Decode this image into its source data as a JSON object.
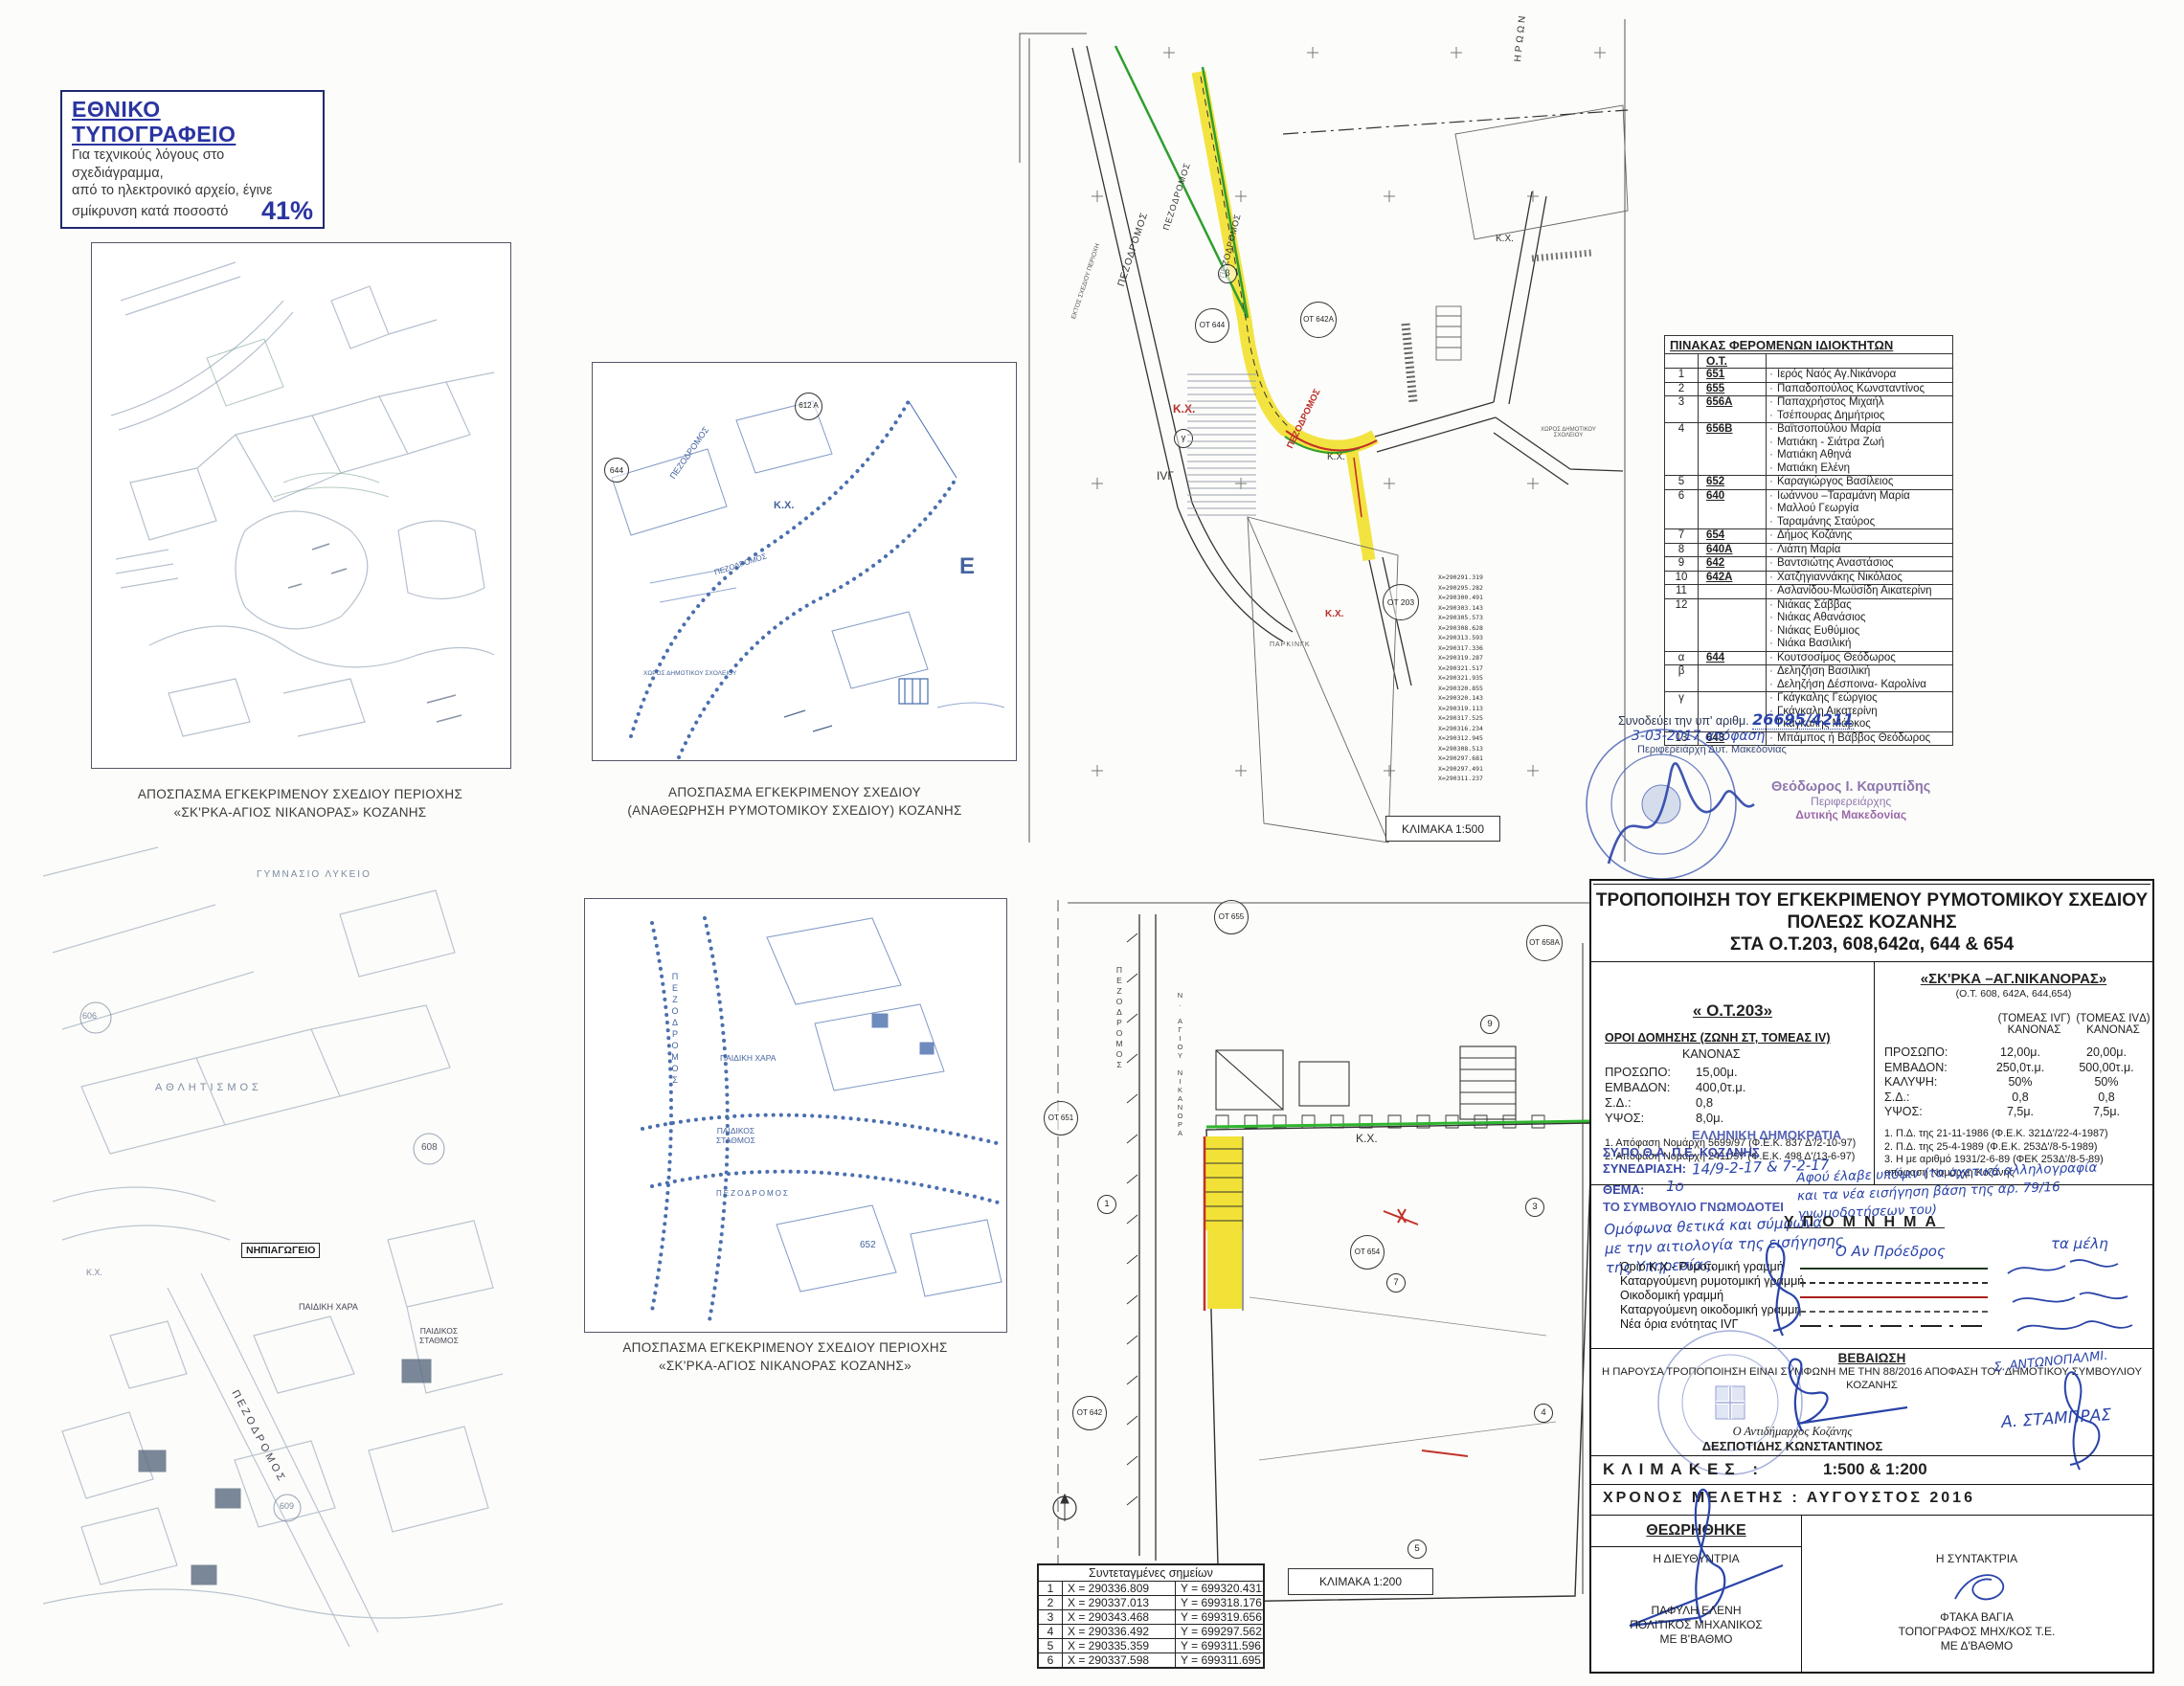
{
  "stamp_box": {
    "title": "ΕΘΝΙΚΟ ΤΥΠΟΓΡΑΦΕΙΟ",
    "line1": "Για τεχνικούς λόγους στο σχεδιάγραμμα,",
    "line2": "από το ηλεκτρονικό αρχείο, έγινε",
    "line3": "σμίκρυνση κατά ποσοστό",
    "percent": "41%"
  },
  "captions": {
    "map_a_line1": "ΑΠΟΣΠΑΣΜΑ ΕΓΚΕΚΡΙΜΕΝΟΥ ΣΧΕΔΙΟΥ ΠΕΡΙΟΧΗΣ",
    "map_a_line2": "«ΣΚ'ΡΚΑ-ΑΓΙΟΣ ΝΙΚΑΝΟΡΑΣ» ΚΟΖΑΝΗΣ",
    "map_b_line1": "ΑΠΟΣΠΑΣΜΑ ΕΓΚΕΚΡΙΜΕΝΟΥ ΣΧΕΔΙΟΥ",
    "map_b_line2": "(ΑΝΑΘΕΩΡΗΣΗ ΡΥΜΟΤΟΜΙΚΟΥ ΣΧΕΔΙΟΥ) ΚΟΖΑΝΗΣ",
    "map_e_line1": "ΑΠΟΣΠΑΣΜΑ ΕΓΚΕΚΡΙΜΕΝΟΥ ΣΧΕΔΙΟΥ ΠΕΡΙΟΧΗΣ",
    "map_e_line2": "«ΣΚ'ΡΚΑ-ΑΓΙΟΣ ΝΙΚΑΝΟΡΑΣ ΚΟΖΑΝΗΣ»"
  },
  "map_labels": {
    "pezodromos": "ΠΕΖΟΔΡΟΜΟΣ",
    "kx": "Κ.Χ.",
    "ot644": "ΟΤ 644",
    "ot642a": "ΟΤ 642Α",
    "ot203": "ΟΤ 203",
    "beta": "β",
    "gamma": "γ",
    "iv_g": "IVΓ",
    "iroon": "ΗΡΩΩΝ",
    "parking": "ΠΑΡΚΙΝΓΚ",
    "school_area_1": "ΧΩΡΟΣ",
    "school_area_2": "ΔΗΜΟΤΙΚΟΥ ΣΧΟΛΕΙΟΥ",
    "off_plan": "ΕΚΤΟΣ ΣΧΕΔΙΟΥ ΠΕΡΙΟΧΗ",
    "e612a": "612 Α",
    "n644": "644",
    "big_e": "Ε",
    "n652": "652",
    "kindergarten": "ΝΗΠΙΑΓΩΓΕΙΟ",
    "playground": "ΠΑΙΔΙΚΗ ΧΑΡΑ",
    "daycare_1": "ΠΑΙΔΙΚΟΣ",
    "daycare_2": "ΣΤΑΘΜΟΣ",
    "sports": "ΑΘΛΗΤΙΣΜΟΣ",
    "gym": "ΓΥΜΝΑΣΙΟ ΛΥΚΕΙΟ",
    "n608": "608",
    "n606": "606",
    "n609": "609",
    "ot655": "ΟΤ 655",
    "ot651": "ΟΤ 651",
    "ot654": "ΟΤ 654",
    "ot658a": "ΟΤ 658Α",
    "ot642": "ΟΤ 642",
    "agiou_nikanora": "Ν. ΑΓΙΟΥ ΝΙΚΑΝΟΡΑ",
    "d1": "1",
    "d3": "3",
    "d4": "4",
    "d5": "5",
    "d7": "7",
    "d9": "9"
  },
  "scale_boxes": {
    "c": "ΚΛΙΜΑΚΑ 1:500",
    "f": "ΚΛΙΜΑΚΑ  1:200"
  },
  "survey_coords_x": [
    "X=290291.319",
    "X=290295.282",
    "X=290300.491",
    "X=290303.143",
    "X=290305.573",
    "X=290308.628",
    "X=290313.593",
    "X=290317.336",
    "X=290319.287",
    "X=290321.517",
    "X=290321.935",
    "X=290320.855",
    "X=290320.143",
    "X=290319.113",
    "X=290317.525",
    "X=290316.234",
    "X=290312.945",
    "X=290308.513",
    "X=290297.681",
    "X=290297.491",
    "X=290311.237"
  ],
  "coords_table": {
    "title": "Συντεταγμένες σημείων",
    "rows": [
      [
        "1",
        "X = 290336.809",
        "Y = 699320.431"
      ],
      [
        "2",
        "X = 290337.013",
        "Y = 699318.176"
      ],
      [
        "3",
        "X = 290343.468",
        "Y = 699319.656"
      ],
      [
        "4",
        "X = 290336.492",
        "Y = 699297.562"
      ],
      [
        "5",
        "X = 290335.359",
        "Y = 699311.596"
      ],
      [
        "6",
        "X = 290337.598",
        "Y = 699311.695"
      ]
    ]
  },
  "owners_table": {
    "title": "ΠΙΝΑΚΑΣ ΦΕΡΟΜΕΝΩΝ ΙΔΙΟΚΤΗΤΩΝ",
    "ot_header": "Ο.Τ.",
    "lines": [
      {
        "n": "1",
        "ot": "651",
        "name": "Ιερός Ναός Αγ.Νικάνορα",
        "s": 1
      },
      {
        "n": "2",
        "ot": "655",
        "name": "Παπαδοπούλος Κωνσταντίνος",
        "s": 1
      },
      {
        "n": "3",
        "ot": "656Α",
        "name": "Παπαχρήστος Μιχαήλ",
        "s": 1
      },
      {
        "n": "",
        "ot": "",
        "name": "Τσέπουρας Δημήτριος",
        "s": 0
      },
      {
        "n": "4",
        "ot": "656Β",
        "name": "Βαϊτσοπούλου Μαρία",
        "s": 1
      },
      {
        "n": "",
        "ot": "",
        "name": "Ματιάκη - Σιάτρα Ζωή",
        "s": 0
      },
      {
        "n": "",
        "ot": "",
        "name": "Ματιάκη Αθηνά",
        "s": 0
      },
      {
        "n": "",
        "ot": "",
        "name": "Ματιάκη  Ελένη",
        "s": 0
      },
      {
        "n": "5",
        "ot": "652",
        "name": "Καραγιώργος Βασίλειος",
        "s": 1
      },
      {
        "n": "6",
        "ot": "640",
        "name": "Ιωάννου –Ταραμάνη Μαρία",
        "s": 1
      },
      {
        "n": "",
        "ot": "",
        "name": "Μαλλού Γεωργία",
        "s": 0
      },
      {
        "n": "",
        "ot": "",
        "name": "Ταραμάνης Σταύρος",
        "s": 0
      },
      {
        "n": "7",
        "ot": "654",
        "name": "Δήμος Κοζάνης",
        "s": 1
      },
      {
        "n": "8",
        "ot": "640Α",
        "name": "Λιάπη Μαρία",
        "s": 1
      },
      {
        "n": "9",
        "ot": "642",
        "name": "Βαντσιώτης Αναστάσιος",
        "s": 1
      },
      {
        "n": "10",
        "ot": "642Α",
        "name": "Χατζηγιαννάκης Νικόλαος",
        "s": 1
      },
      {
        "n": "11",
        "ot": "",
        "name": "Ασλανίδου-Μωϋσίδη Αικατερίνη",
        "s": 1
      },
      {
        "n": "12",
        "ot": "",
        "name": "Νιάκας Σάββας",
        "s": 1
      },
      {
        "n": "",
        "ot": "",
        "name": "Νιάκας Αθανάσιος",
        "s": 0
      },
      {
        "n": "",
        "ot": "",
        "name": "Νιάκας Ευθύμιος",
        "s": 0
      },
      {
        "n": "",
        "ot": "",
        "name": "Νιάκα Βασιλική",
        "s": 0
      },
      {
        "n": "α",
        "ot": "644",
        "name": "Κουτσοσίμος Θεόδωρος",
        "s": 1
      },
      {
        "n": "β",
        "ot": "",
        "name": "Δεληζήση Βασιλική",
        "s": 1
      },
      {
        "n": "",
        "ot": "",
        "name": "Δεληζήση Δέσποινα- Καρολίνα",
        "s": 0
      },
      {
        "n": "γ",
        "ot": "",
        "name": "Γκάγκαλης Γεώργιος",
        "s": 1
      },
      {
        "n": "",
        "ot": "",
        "name": "Γκάγκαλη Αικατερίνη",
        "s": 0
      },
      {
        "n": "",
        "ot": "",
        "name": "Γκάγκαλης Μάρκος",
        "s": 0
      },
      {
        "n": "13",
        "ot": "643",
        "name": "Μπάμπος ή Βάββος Θεόδωρος",
        "s": 1
      }
    ]
  },
  "approval_note": {
    "prefix": "Συνοδεύει την υπ' αριθμ.",
    "number": "26695/4211",
    "line2": "3-03-2017 απόφαση",
    "line3": "Περιφερειάρχη Δυτ. Μακεδονίας",
    "stamp_name": "Θεόδωρος Ι. Καρυπίδης",
    "stamp_role": "Περιφερειάρχης",
    "stamp_region": "Δυτικής Μακεδονίας"
  },
  "title_block": {
    "title_line1": "ΤΡΟΠΟΠΟΙΗΣΗ ΤΟΥ ΕΓΚΕΚΡΙΜΕΝΟΥ ΡΥΜΟΤΟΜΙΚΟΥ ΣΧΕΔΙΟΥ",
    "title_line2": "ΠΟΛΕΩΣ ΚΟΖΑΝΗΣ",
    "title_line3": "ΣΤΑ Ο.Τ.203, 608,642α, 644 & 654",
    "left": {
      "heading": "« Ο.Τ.203»",
      "subheading": "ΟΡΟΙ ΔΟΜΗΣΗΣ  (ΖΩΝΗ ΣΤ, ΤΟΜΕΑΣ IV)",
      "kanonas": "ΚΑΝΟΝΑΣ",
      "rows": [
        {
          "k": "ΠΡΟΣΩΠΟ:",
          "v": "15,00μ."
        },
        {
          "k": "ΕΜΒΑΔΟΝ:",
          "v": "400,0τ.μ."
        },
        {
          "k": "Σ.Δ.:",
          "v": "0,8"
        },
        {
          "k": "ΥΨΟΣ:",
          "v": "8,0μ."
        }
      ],
      "notes": [
        "1.  Απόφαση Νομάρχη 5699/97 (Φ.Ε.Κ. 837 Δ'/2-10-97)",
        "2.  Απόφαση Νομάρχη 2411/97 (Φ.Ε.Κ. 498 Δ'/13-6-97)"
      ]
    },
    "right": {
      "heading": "«ΣΚ'ΡΚΑ –ΑΓ.ΝΙΚΑΝΟΡΑΣ»",
      "subheading": "(Ο.Τ. 608, 642Α, 644,654)",
      "col1a": "(ΤΟΜΕΑΣ IVΓ)",
      "col1b": "ΚΑΝΟΝΑΣ",
      "col2a": "(ΤΟΜΕΑΣ IVΔ)",
      "col2b": "ΚΑΝΟΝΑΣ",
      "rows": [
        {
          "k": "ΠΡΟΣΩΠΟ:",
          "v1": "12,00μ.",
          "v2": "20,00μ."
        },
        {
          "k": "ΕΜΒΑΔΟΝ:",
          "v1": "250,0τ.μ.",
          "v2": "500,00τ.μ."
        },
        {
          "k": "ΚΑΛΥΨΗ:",
          "v1": "50%",
          "v2": "50%"
        },
        {
          "k": "Σ.Δ.:",
          "v1": "0,8",
          "v2": "0,8"
        },
        {
          "k": "ΥΨΟΣ:",
          "v1": "7,5μ.",
          "v2": "7,5μ."
        }
      ],
      "notes": [
        "1.  Π.Δ. της 21-11-1986 (Φ.Ε.Κ. 321Δ'/22-4-1987)",
        "2.  Π.Δ. της 25-4-1989 (Φ.Ε.Κ. 253Δ'/8-5-1989)",
        "3.  Η με αριθμό 1931/2-6-89 (ΦΕΚ 253Δ'/8-5-89) απόφαση Νομάρχη Κοζάνης"
      ]
    },
    "sypotha": {
      "agency1": "ΕΛΛΗΝΙΚΗ ΔΗΜΟΚΡΑΤΙΑ",
      "agency2": "ΣΥ.ΠΟ.Θ.Α. Π.Ε. ΚΟΖΑΝΗΣ",
      "session_label": "ΣΥΝΕΔΡΙΑΣΗ:",
      "session_value": "14/9-2-17 & 7-2-17",
      "theme_label": "ΘΕΜΑ:",
      "theme_value": "1ο",
      "council": "ΤΟ ΣΥΜΒΟΥΛΙΟ ΓΝΩΜΟΔΟΤΕΙ",
      "hw_left1": "Ομόφωνα θετικά και σύμφωνα",
      "hw_left2": "με την αιτιολογία της εισήγησης",
      "hw_left3": "της Υπηρεσίας.",
      "hw_right1": "Αφού έλαβε υπόψιν (τα σχετικά αλληλογραφία",
      "hw_right2": "και τα νέα εισήγηση βάση της αρ. 79/16",
      "hw_right3": "γνωμοδοτήσεων του)"
    },
    "legend": {
      "title": "ΥΠΟΜΝΗΜΑ",
      "chairman": "Ο Αν Πρόεδρος",
      "members": "τα μέλη",
      "items": [
        {
          "label": "Όριο Κ.Χ.- Ρυμοτομική γραμμή",
          "style": "solid-dark"
        },
        {
          "label": "Καταργούμενη ρυμοτομική γραμμή",
          "style": "dashed-dark"
        },
        {
          "label": "Οικοδομική  γραμμή",
          "style": "solid-red"
        },
        {
          "label": "Καταργούμενη οικοδομική γραμμή",
          "style": "dashed-gray"
        },
        {
          "label": "Νέα όρια ενότητας  IVΓ",
          "style": "dashdot-dark"
        }
      ],
      "sign1": "Σ. ΑΝΤΩΝΟΠΑΛΜΙ.",
      "sign2": "Α. ΣΤΑΜΠΡΑΣ"
    },
    "bebaiosi": {
      "title": "ΒΕΒΑΙΩΣΗ",
      "text1": "Η ΠΑΡΟΥΣΑ ΤΡΟΠΟΠΟΙΗΣΗ ΕΙΝΑΙ ΣΥΜΦΩΝΗ ΜΕ ΤΗΝ 88/2016 ΑΠΟΦΑΣΗ ΤΟΥ ΔΗΜΟΤΙΚΟΥ ΣΥΜΒΟΥΛΙΟΥ",
      "text2": "ΚΟΖΑΝΗΣ",
      "signer_title": "Ο Αντιδήμαρχος Κοζάνης",
      "signer_name": "ΔΕΣΠΟΤΙΔΗΣ ΚΩΝΣΤΑΝΤΙΝΟΣ"
    },
    "scales_label": "ΚΛΙΜΑΚΕΣ :",
    "scales_value": "1:500 & 1:200",
    "time_label": "ΧΡΟΝΟΣ ΜΕΛΕΤΗΣ : ΑΥΓΟΥΣΤΟΣ 2016",
    "theorithike": {
      "title": "ΘΕΩΡΗΘΗΚΕ",
      "left_role": "Η ΔΙΕΥΘΥΝΤΡΙΑ",
      "left_name": "ΠΑΦΥΛΗ ΕΛΕΝΗ",
      "left_title1": "ΠΟΛΙΤΙΚΟΣ ΜΗΧΑΝΙΚΟΣ",
      "left_title2": "ΜΕ Β'ΒΑΘΜΟ",
      "right_role": "Η ΣΥΝΤΑΚΤΡΙΑ",
      "right_name": "ΦΤΑΚΑ ΒΑΓΙΑ",
      "right_title1": "ΤΟΠΟΓΡΑΦΟΣ ΜΗΧ/ΚΟΣ Τ.Ε.",
      "right_title2": "ΜΕ Δ'ΒΑΘΜΟ"
    }
  }
}
